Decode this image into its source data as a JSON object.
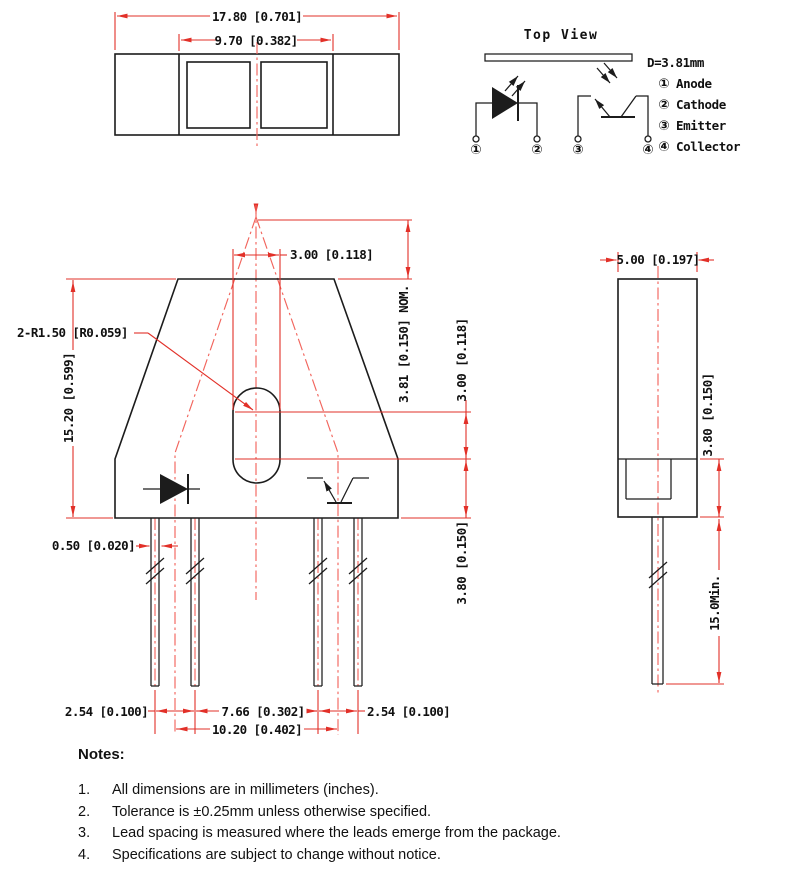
{
  "colors": {
    "dimension_red": "#e23028",
    "centerline_red": "#f2655d",
    "line_black": "#1c1c1c"
  },
  "package_top_view": {
    "dim_overall_width": "17.80 [0.701]",
    "dim_window_width": "9.70 [0.382]"
  },
  "schematic": {
    "title": "Top View",
    "distance_label": "D=3.81mm",
    "pin_marks": [
      "①",
      "②",
      "③",
      "④"
    ],
    "legend": [
      {
        "num": "①",
        "name": "Anode"
      },
      {
        "num": "②",
        "name": "Cathode"
      },
      {
        "num": "③",
        "name": "Emitter"
      },
      {
        "num": "④",
        "name": "Collector"
      }
    ]
  },
  "front_view": {
    "dim_slot_width": "3.00 [0.118]",
    "dim_focal_height": "3.81 [0.150] NOM.",
    "dim_slot_radius": "2-R1.50 [R0.059]",
    "dim_body_height": "15.20 [0.599]",
    "dim_arc_centers": "3.00 [0.118]",
    "dim_slot_to_base": "3.80 [0.150]",
    "dim_lead_width": "0.50 [0.020]",
    "dim_pitch_left": "2.54 [0.100]",
    "dim_pitch_center": "7.66 [0.302]",
    "dim_pitch_right": "2.54 [0.100]",
    "dim_axis_span": "10.20 [0.402]"
  },
  "side_view": {
    "dim_body_width": "5.00 [0.197]",
    "dim_step_height": "3.80 [0.150]",
    "dim_lead_length": "15.0Min."
  },
  "notes": {
    "heading": "Notes:",
    "items": [
      {
        "num": "1.",
        "text": "All dimensions are in millimeters (inches)."
      },
      {
        "num": "2.",
        "text": "Tolerance is ±0.25mm unless otherwise specified."
      },
      {
        "num": "3.",
        "text": "Lead spacing is measured where the leads emerge from the package."
      },
      {
        "num": "4.",
        "text": "Specifications are subject to change without notice."
      }
    ]
  }
}
